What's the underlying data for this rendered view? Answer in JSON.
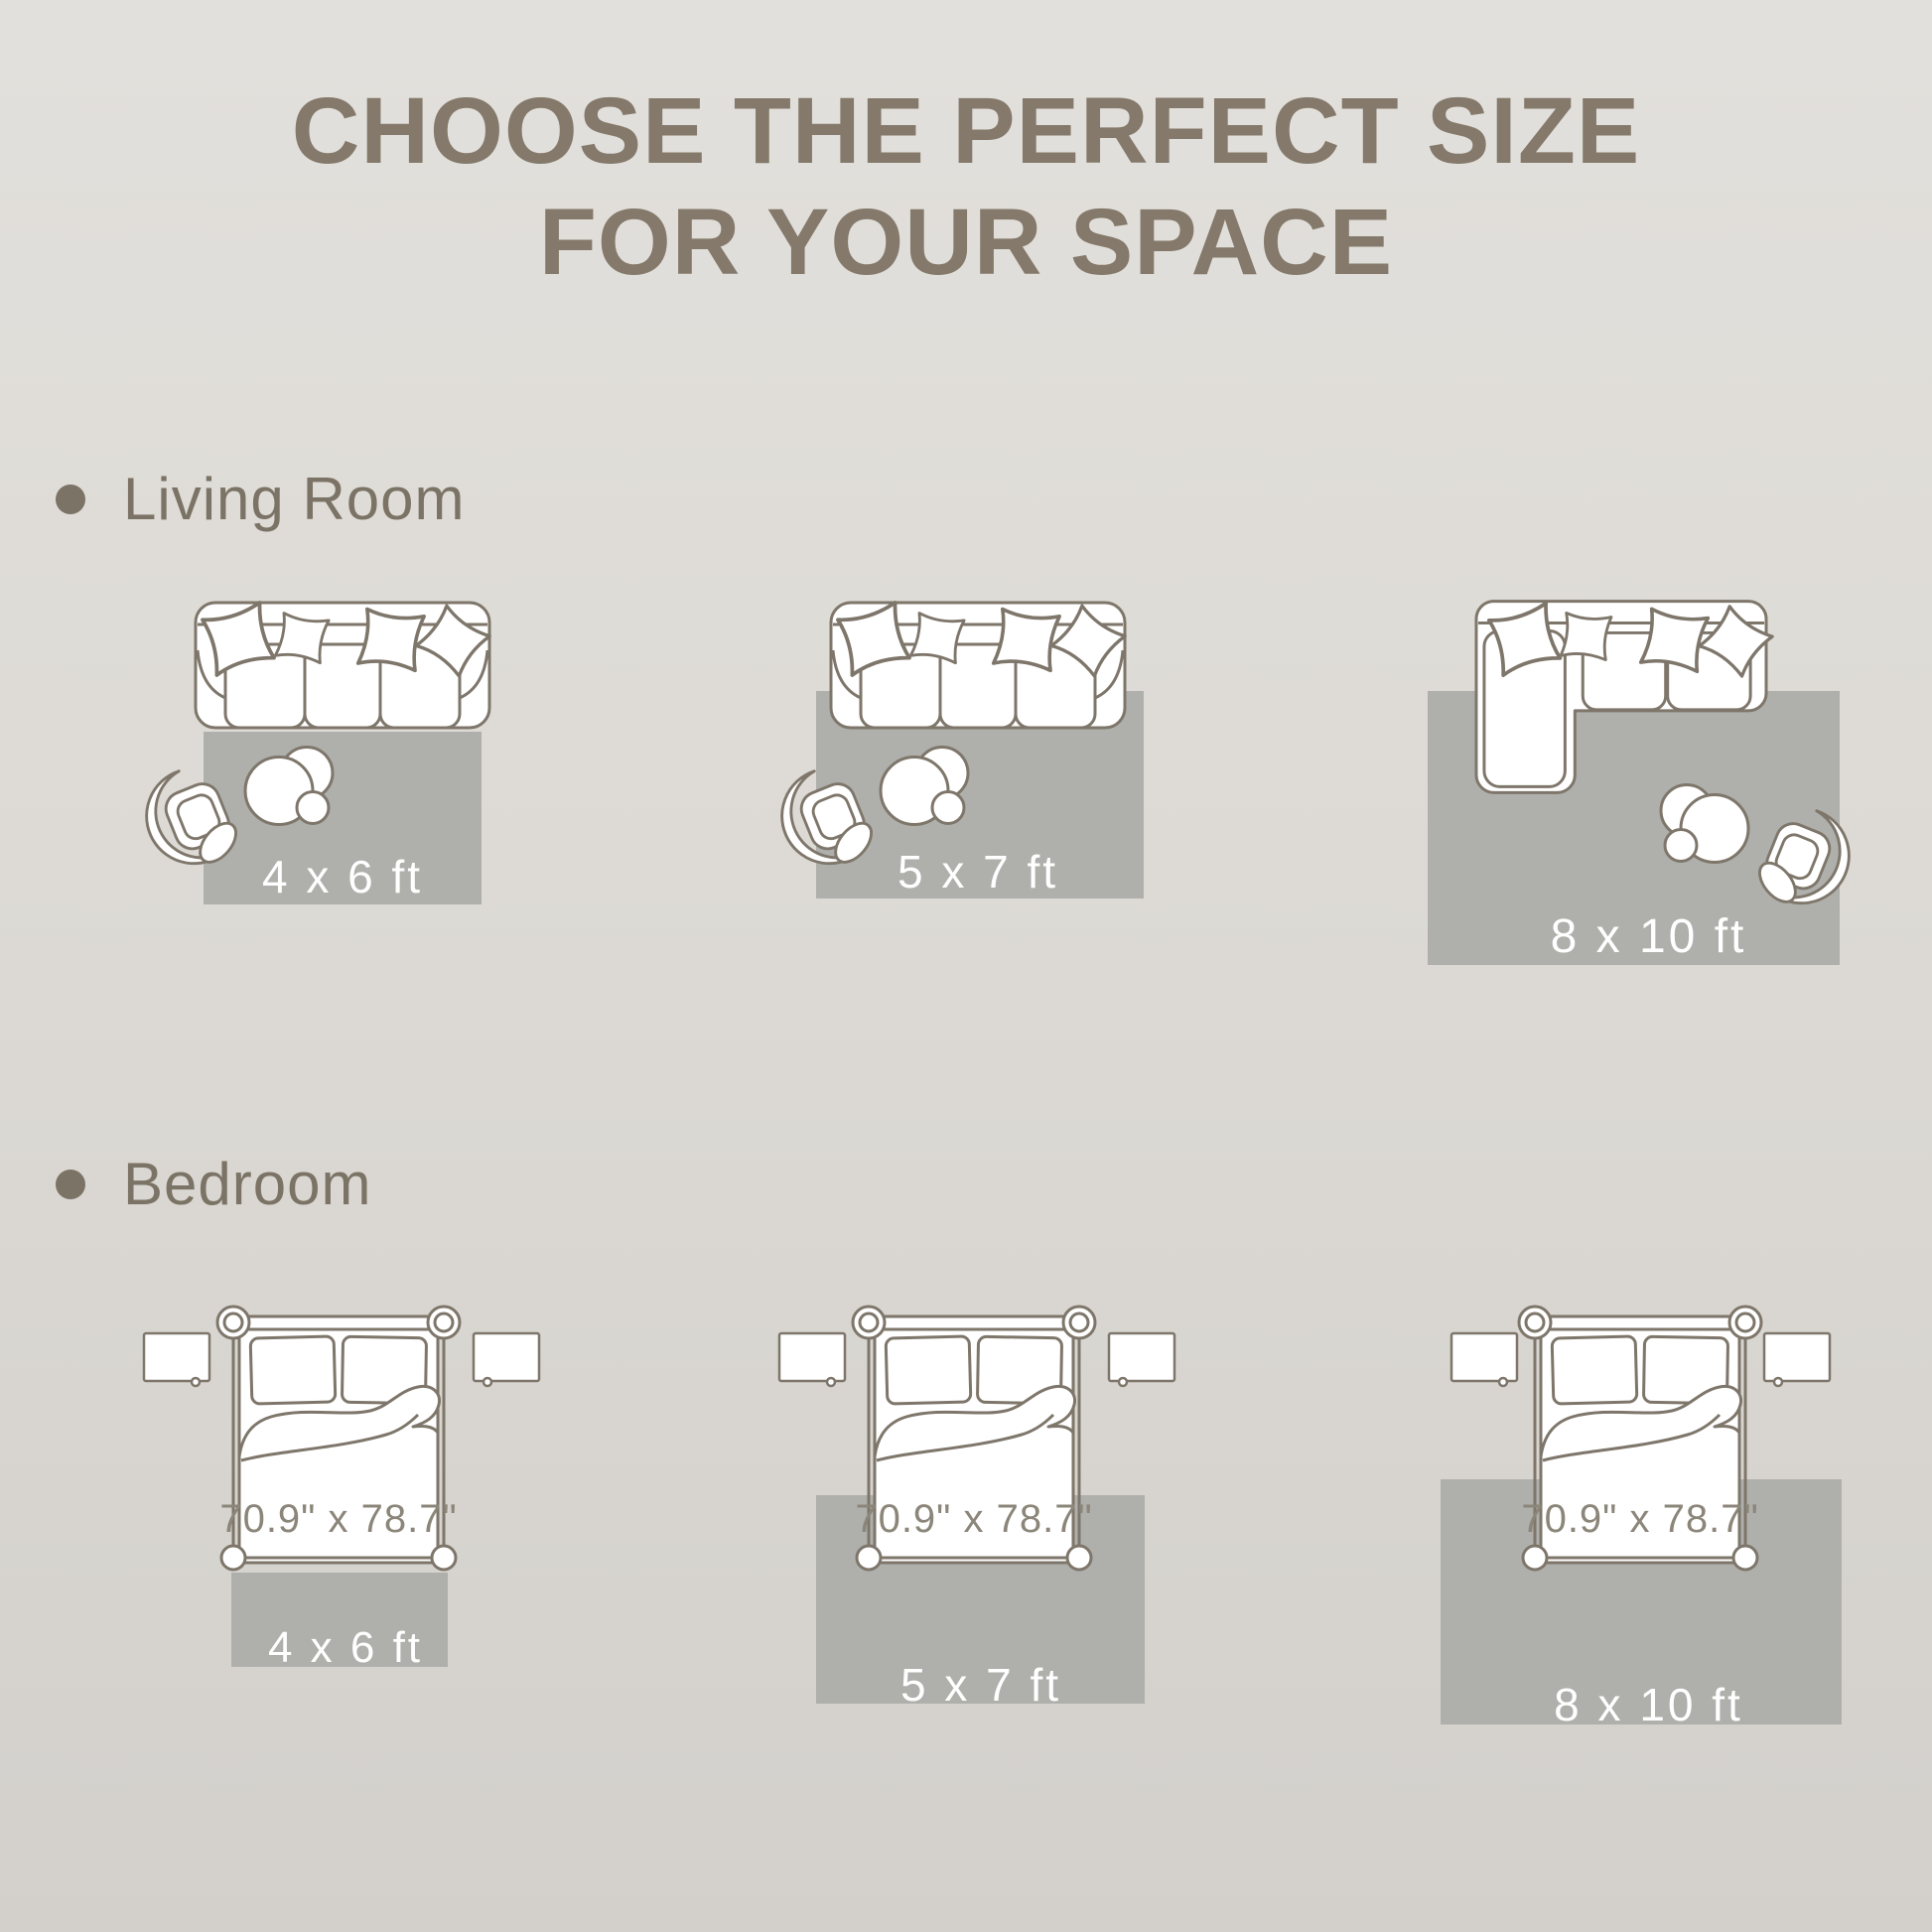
{
  "title": {
    "line1": "CHOOSE THE PERFECT SIZE",
    "line2": "FOR YOUR SPACE"
  },
  "sections": [
    {
      "label": "Living Room",
      "layouts": [
        {
          "rug_size": "4 x 6 ft"
        },
        {
          "rug_size": "5 x 7 ft"
        },
        {
          "rug_size": "8 x 10 ft"
        }
      ]
    },
    {
      "label": "Bedroom",
      "bed_dimensions": "70.9\" x 78.7\"",
      "layouts": [
        {
          "rug_size": "4 x 6 ft"
        },
        {
          "rug_size": "5 x 7 ft"
        },
        {
          "rug_size": "8 x 10 ft"
        }
      ]
    }
  ],
  "colors": {
    "background_top": "#e2e0dc",
    "background_bottom": "#d3d0cc",
    "rug": "#afb0ac",
    "furniture_outline": "#7e766a",
    "furniture_fill": "#ffffff",
    "title_text": "#84796a",
    "section_text": "#7b7365",
    "rug_label_text": "#ffffff",
    "bed_label_text": "#8b8679"
  }
}
